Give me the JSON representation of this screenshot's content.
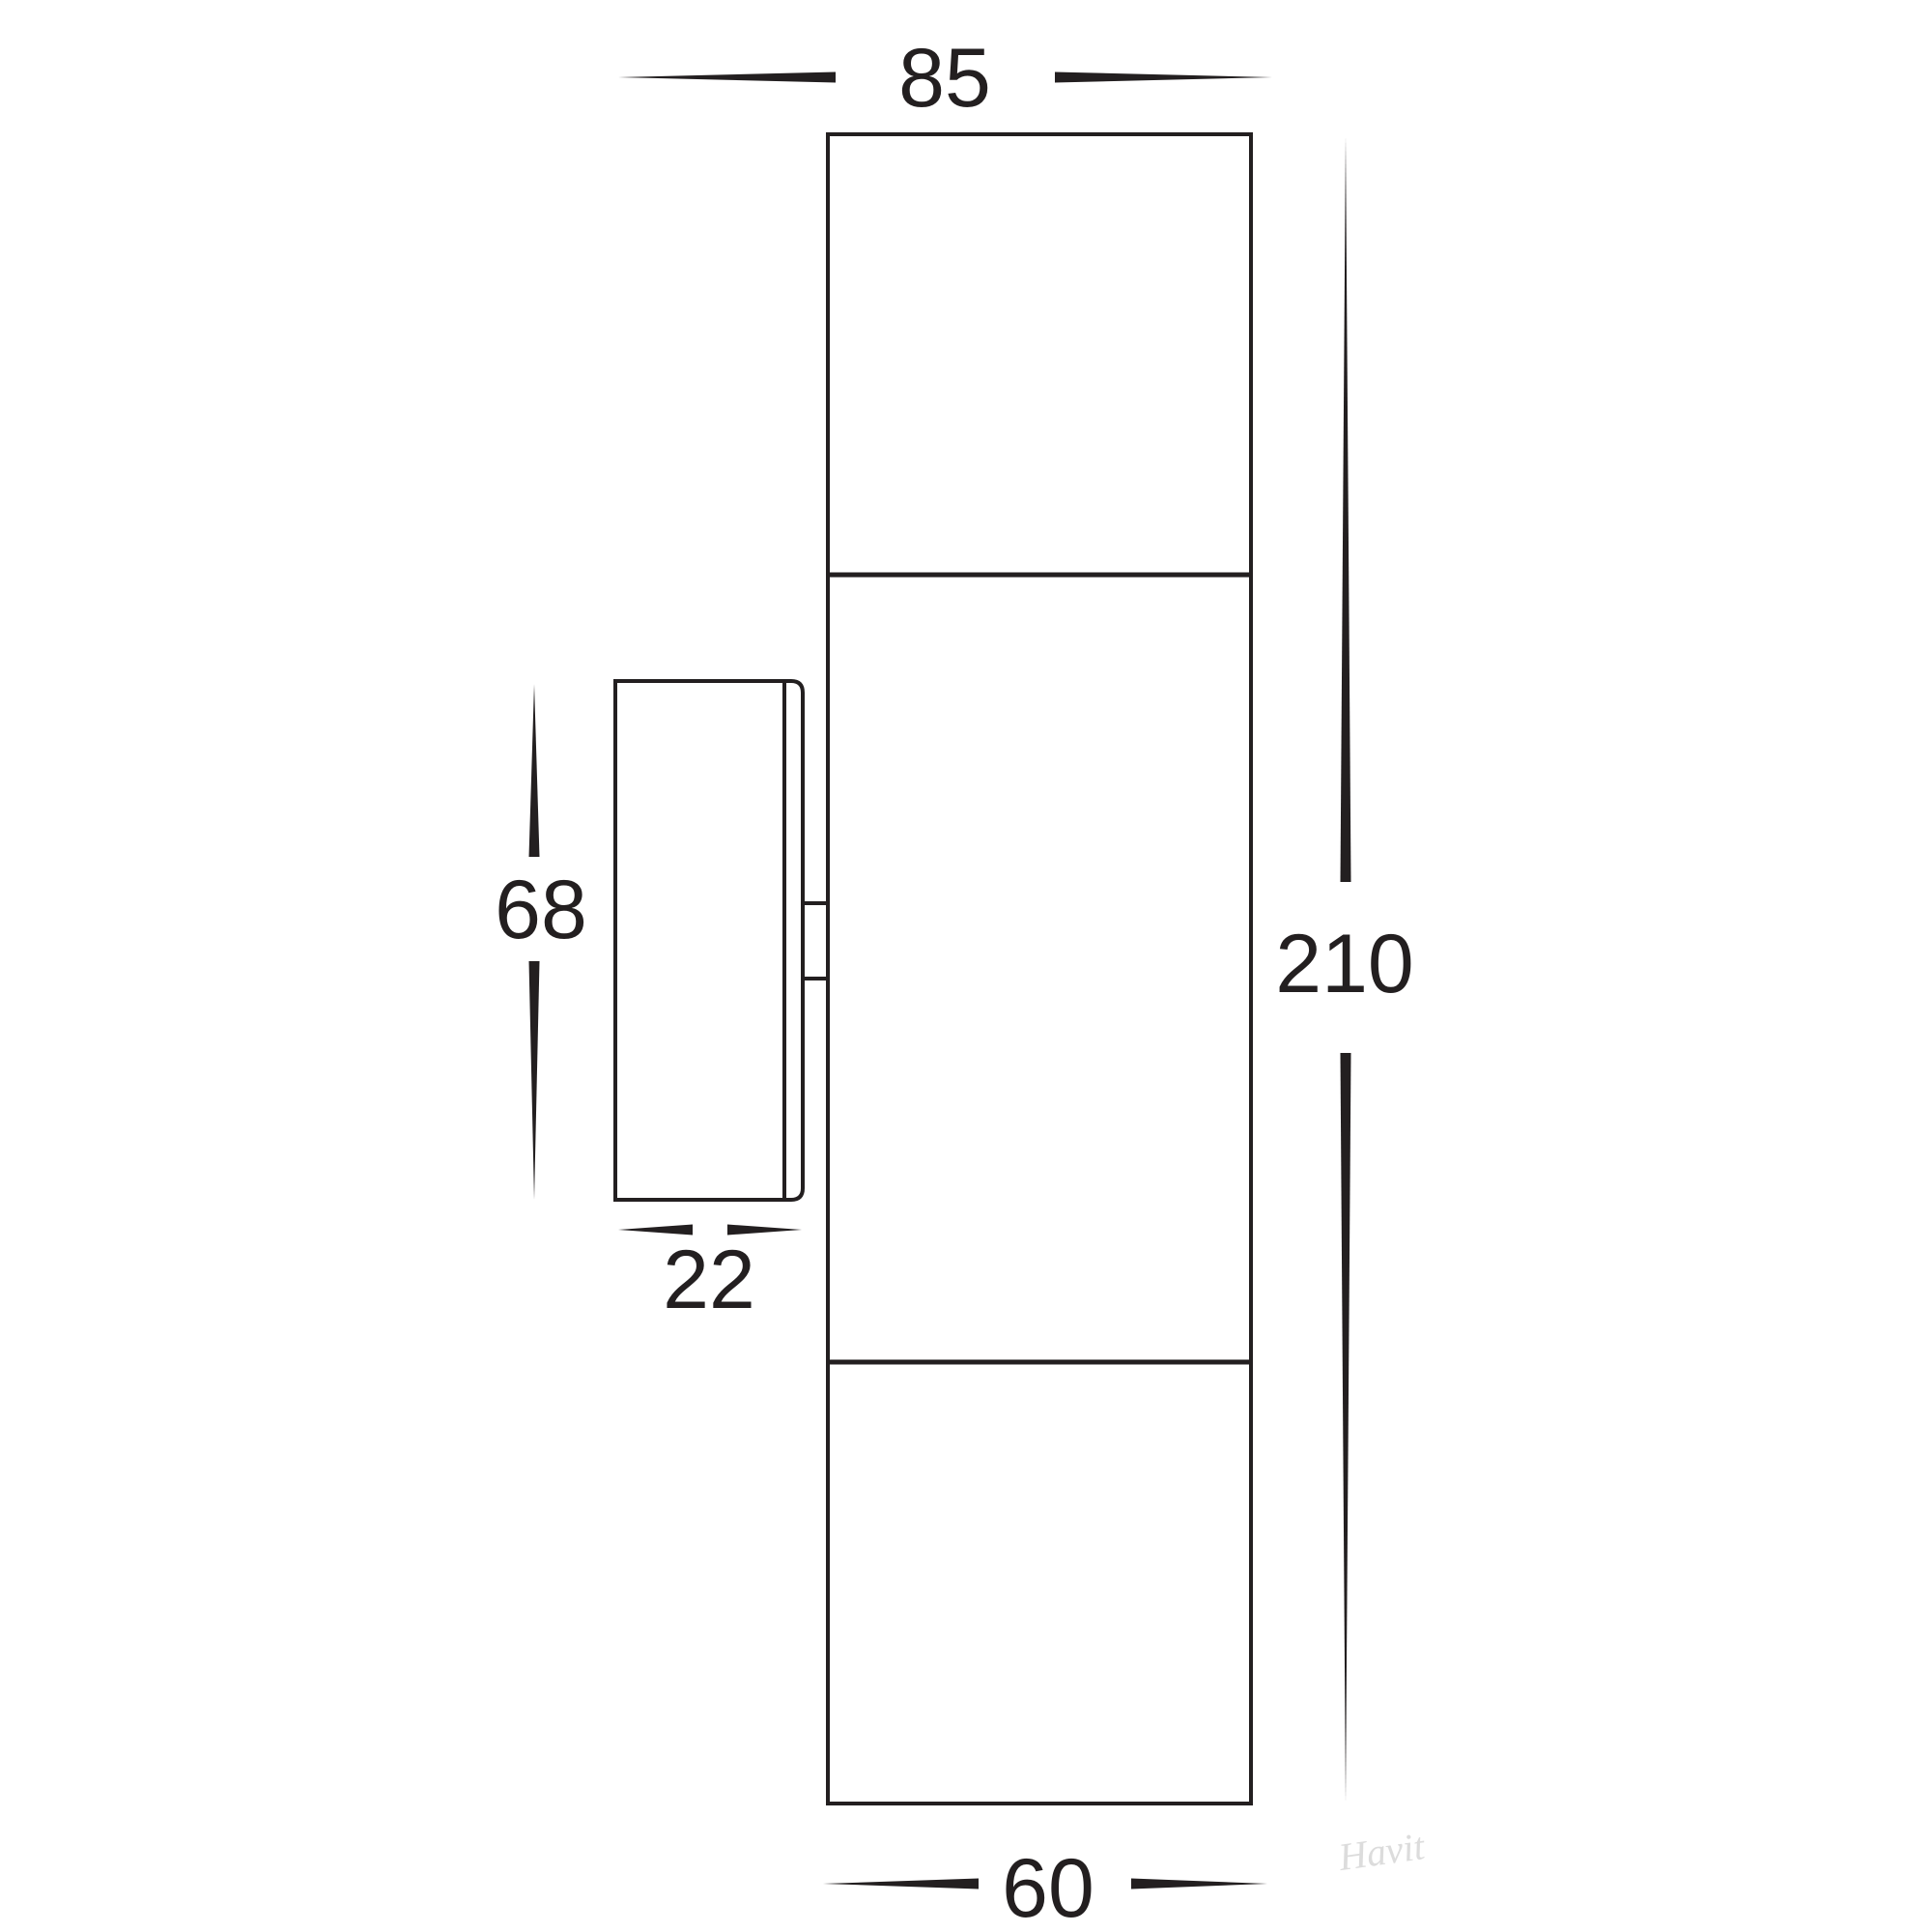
{
  "diagram": {
    "title": "wall-light-dimension-drawing",
    "dimensions": {
      "top_width": "85",
      "overall_height": "210",
      "backplate_height": "68",
      "backplate_depth": "22",
      "bottom_width": "60"
    },
    "watermark": "Havit",
    "colors": {
      "line": "#231f20",
      "watermark": "#dcdcdc",
      "background": "#ffffff"
    }
  }
}
